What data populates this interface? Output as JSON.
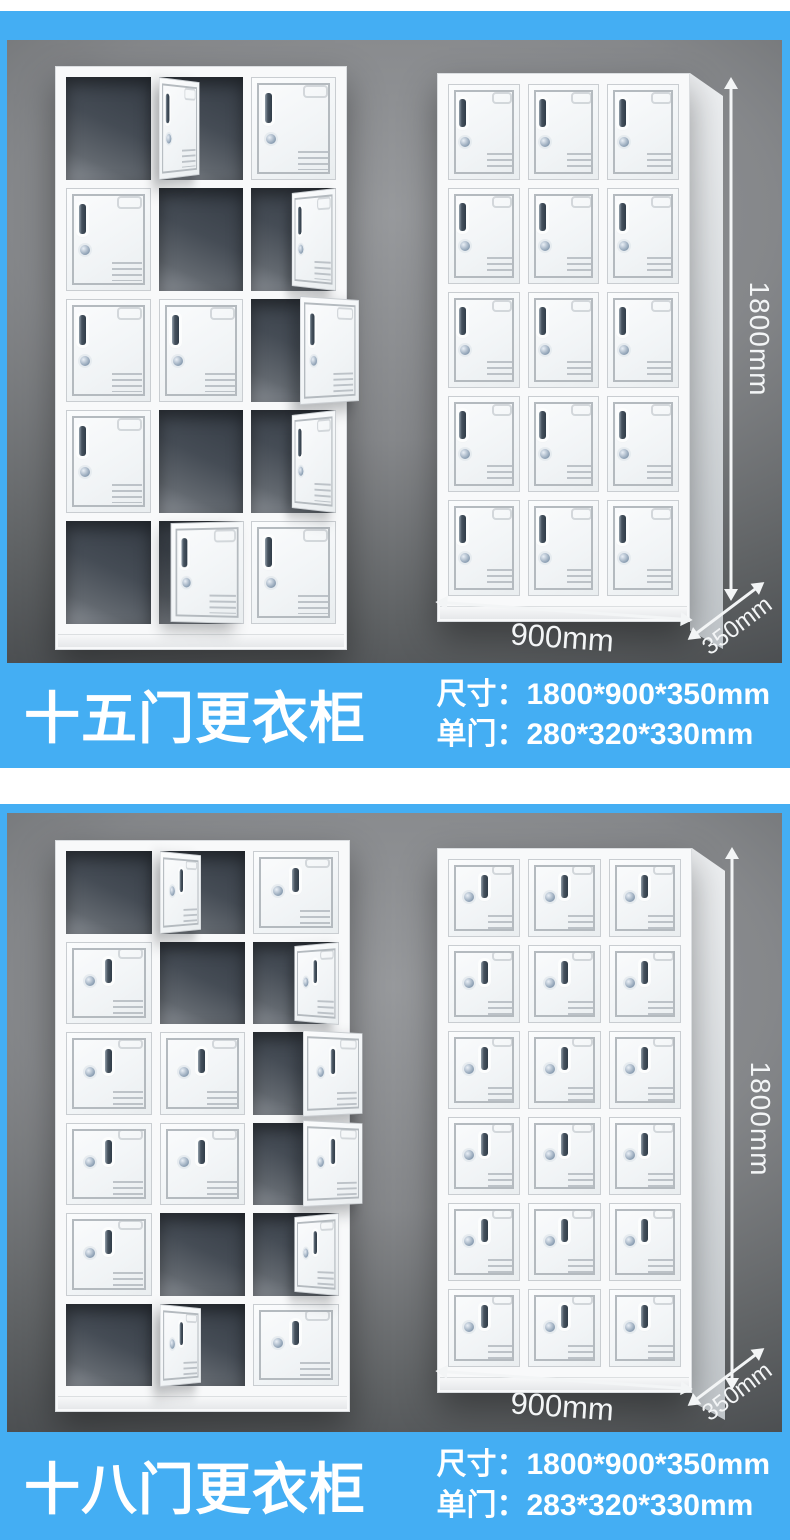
{
  "colors": {
    "accent": "#44aef3",
    "panel_gray_top": "#97999c",
    "panel_gray_bottom": "#3a3d40",
    "dimension_text": "#f3f5f6",
    "banner_text": "#ffffff",
    "cabinet_white": "#f8f9fa"
  },
  "sections": [
    {
      "name": "fifteen-door-locker",
      "dims": {
        "height": "1800mm",
        "width": "900mm",
        "depth": "350mm"
      },
      "banner": {
        "title": "十五门更衣柜",
        "spec_size": "尺寸：1800*900*350mm",
        "spec_door": "单门：280*320*330mm"
      }
    },
    {
      "name": "eighteen-door-locker",
      "dims": {
        "height": "1800mm",
        "width": "900mm",
        "depth": "350mm"
      },
      "banner": {
        "title": "十八门更衣柜",
        "spec_size": "尺寸：1800*900*350mm",
        "spec_door": "单门：283*320*330mm"
      }
    }
  ],
  "lockers": {
    "open15": {
      "rows": 5,
      "cols": 3,
      "handle": "left",
      "cells": [
        [
          "o",
          "dL",
          "c"
        ],
        [
          "c",
          "o",
          "dR"
        ],
        [
          "c",
          "c",
          "dO"
        ],
        [
          "c",
          "o",
          "dR"
        ],
        [
          "o",
          "aj",
          "c"
        ]
      ]
    },
    "closed15": {
      "rows": 5,
      "cols": 3,
      "handle": "left",
      "cells": [
        [
          "c",
          "c",
          "c"
        ],
        [
          "c",
          "c",
          "c"
        ],
        [
          "c",
          "c",
          "c"
        ],
        [
          "c",
          "c",
          "c"
        ],
        [
          "c",
          "c",
          "c"
        ]
      ]
    },
    "open18": {
      "rows": 6,
      "cols": 3,
      "handle": "center",
      "cells": [
        [
          "o",
          "dL",
          "c"
        ],
        [
          "c",
          "o",
          "dR"
        ],
        [
          "c",
          "c",
          "dO"
        ],
        [
          "c",
          "c",
          "dO"
        ],
        [
          "c",
          "o",
          "dR"
        ],
        [
          "o",
          "dL",
          "c"
        ]
      ]
    },
    "closed18": {
      "rows": 6,
      "cols": 3,
      "handle": "center",
      "cells": [
        [
          "c",
          "c",
          "c"
        ],
        [
          "c",
          "c",
          "c"
        ],
        [
          "c",
          "c",
          "c"
        ],
        [
          "c",
          "c",
          "c"
        ],
        [
          "c",
          "c",
          "c"
        ],
        [
          "c",
          "c",
          "c"
        ]
      ]
    }
  }
}
